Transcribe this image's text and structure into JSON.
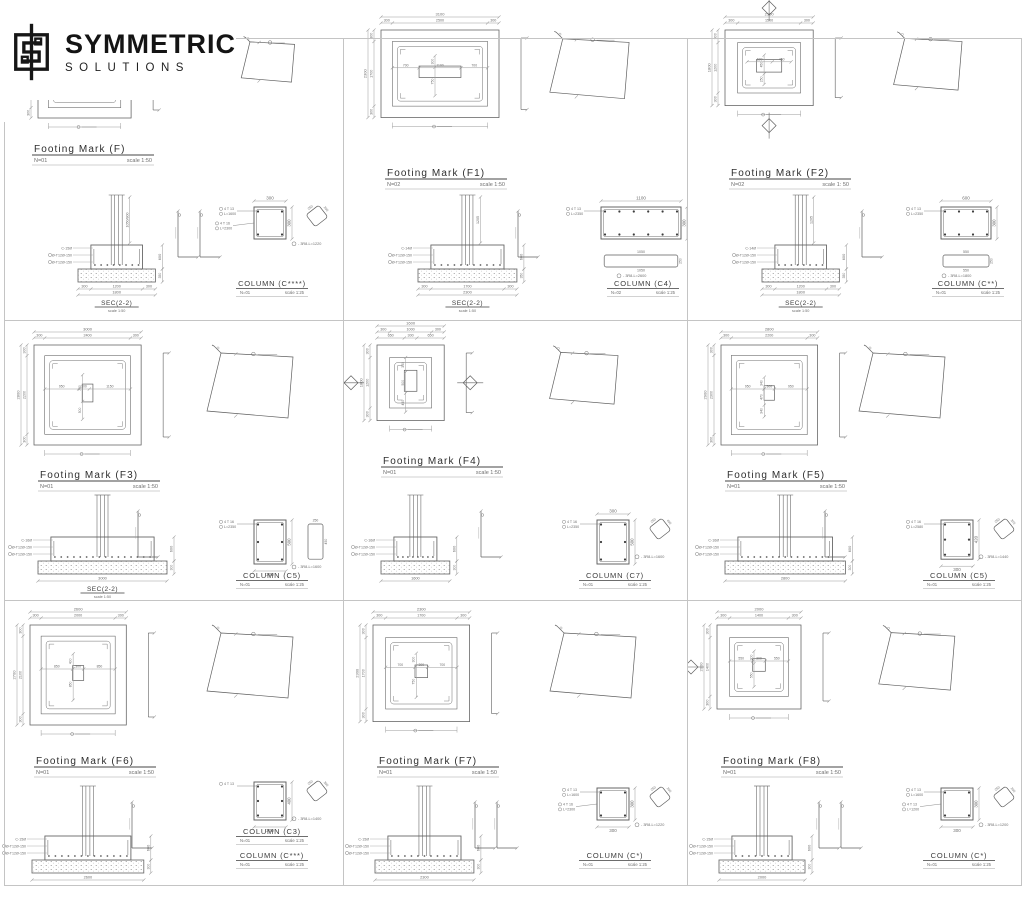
{
  "brand": {
    "name": "SYMMETRIC",
    "sub": "SOLUTIONS"
  },
  "colors": {
    "line": "#5f5f5f",
    "dim": "#9b9b9b",
    "text": "#6e6e6e",
    "title": "#3c3c3c"
  },
  "panels": [
    {
      "footing": {
        "title": "Footing Mark (F)",
        "count": "N=01",
        "scale": "scale 1:50"
      },
      "plan": {
        "partial": true,
        "w_total": "",
        "w_segs": [],
        "h_total": "",
        "h_segs": [
          "",
          "",
          "300"
        ],
        "inner_h": [],
        "inner_v": [],
        "markers": []
      },
      "sec": {
        "title": "SEC(2-2)",
        "scale": "scale 1:50",
        "total": "1800",
        "segs": [
          "300",
          "1200",
          "300"
        ],
        "depth": "600",
        "base": "350",
        "stem": "1050/800",
        "callouts": [
          "C-15Ø",
          "Ø-T12Ø-150",
          "Ø-T12Ø-150"
        ],
        "l_bars": 2
      },
      "column": {
        "w": "300",
        "h": "300",
        "w_pos": "top",
        "h_pos": "right",
        "bars": [
          "4 T 13",
          "L=1600"
        ],
        "bars2": [
          "4 T 16",
          "L=2300"
        ],
        "tie": "3R8-L=1220",
        "stirrup": {
          "orient": "tilt",
          "dims": [
            "250",
            "250"
          ]
        },
        "titles": [
          {
            "title": "COLUMN (C****)",
            "count": "N=01",
            "scale": "scale 1:25"
          }
        ]
      }
    },
    {
      "footing": {
        "title": "Footing Mark (F1)",
        "count": "N=02",
        "scale": "scale 1:50"
      },
      "plan": {
        "w_total": "3100",
        "w_segs": [
          "300",
          "2500",
          "300"
        ],
        "h_total": "2300",
        "h_segs": [
          "300",
          "1700",
          "300"
        ],
        "inner_h": [
          "700",
          "1100",
          "700"
        ],
        "inner_v": [
          "300",
          "750"
        ],
        "markers": []
      },
      "sec": {
        "title": "SEC(2-2)",
        "scale": "scale 1:50",
        "total": "2300",
        "segs": [
          "300",
          "1700",
          "300"
        ],
        "depth": "600",
        "base": "350",
        "stem": "1205",
        "callouts": [
          "C-14Ø",
          "Ø-T12Ø-150",
          "Ø-T12Ø-150"
        ],
        "l_bars": 1
      },
      "column": {
        "w": "1100",
        "h": "300",
        "w_pos": "top",
        "h_pos": "right",
        "bars": [
          "4 T 13",
          "L=2350"
        ],
        "tie": "3R8-L=2600",
        "stirrup": {
          "orient": "h",
          "dims": [
            "1050",
            "250",
            "1050"
          ]
        },
        "titles": [
          {
            "title": "COLUMN (C4)",
            "count": "N=02",
            "scale": "scale 1:25"
          }
        ]
      }
    },
    {
      "footing": {
        "title": "Footing Mark (F2)",
        "count": "N=02",
        "scale": "scale 1: 50"
      },
      "plan": {
        "w_total": "2100",
        "w_segs": [
          "300",
          "1500",
          "300"
        ],
        "h_total": "1800",
        "h_segs": [
          "300",
          "1200",
          "300"
        ],
        "inner_h": [
          "600",
          "450"
        ],
        "inner_v": [
          "450",
          "250"
        ],
        "markers": [
          "top",
          "bottom"
        ]
      },
      "sec": {
        "title": "SEC(2-2)",
        "scale": "scale 1:50",
        "total": "1800",
        "segs": [
          "300",
          "1200",
          "300"
        ],
        "depth": "600",
        "base": "350",
        "stem": "1205",
        "callouts": [
          "C-14Ø",
          "Ø-T12Ø-150",
          "Ø-T12Ø-150"
        ],
        "l_bars": 1
      },
      "column": {
        "w": "600",
        "h": "300",
        "w_pos": "top",
        "h_pos": "right",
        "bars": [
          "4 T 13",
          "L=2350"
        ],
        "tie": "3R8-L=1800",
        "stirrup": {
          "orient": "h",
          "dims": [
            "550",
            "250",
            "550"
          ]
        },
        "titles": [
          {
            "title": "COLUMN (C**)",
            "count": "N=01",
            "scale": "scale 1:25"
          }
        ]
      }
    },
    {
      "footing": {
        "title": "Footing Mark (F3)",
        "count": "N=01",
        "scale": "scale 1:50"
      },
      "plan": {
        "w_total": "3000",
        "w_segs": [
          "300",
          "2400",
          "300"
        ],
        "h_total": "2800",
        "h_segs": [
          "300",
          "2200",
          "300"
        ],
        "inner_h": [
          "950",
          "300",
          "1150"
        ],
        "inner_v": [
          "750",
          "500"
        ],
        "markers": []
      },
      "sec": {
        "title": "SEC(2-2)",
        "scale": "scale 1:50",
        "total": "3000",
        "segs": [],
        "depth": "600",
        "base": "300",
        "stem": "",
        "callouts": [
          "C-16Ø",
          "Ø-T12Ø-150",
          "Ø-T12Ø-150"
        ],
        "l_bars": 1
      },
      "column": {
        "w": "300",
        "h": "500",
        "w_pos": "bottom",
        "h_pos": "right",
        "bars": [
          "4 T 16",
          "L=2350"
        ],
        "tie": "3R8-L=1600",
        "stirrup": {
          "orient": "v",
          "dims": [
            "250",
            "450"
          ]
        },
        "titles": [
          {
            "title": "COLUMN (C5)",
            "count": "N=01",
            "scale": "scale 1:25"
          }
        ]
      }
    },
    {
      "footing": {
        "title": "Footing Mark (F4)",
        "count": "N=01",
        "scale": "scale 1:50"
      },
      "plan": {
        "w_total": "1600",
        "w_segs": [
          "300",
          "1000",
          "300"
        ],
        "w_segs2": [
          "650",
          "300",
          "650"
        ],
        "h_total": "1800",
        "h_segs": [
          "300",
          "1200",
          "300"
        ],
        "inner_h": [],
        "inner_v": [
          "350",
          "500",
          "450"
        ],
        "markers": [
          "left",
          "right"
        ]
      },
      "sec": {
        "title": "",
        "scale": "",
        "total": "1600",
        "segs": [],
        "depth": "600",
        "base": "300",
        "stem": "",
        "callouts": [
          "C-16Ø",
          "Ø-T12Ø-150",
          "Ø-T12Ø-150"
        ],
        "l_bars": 1
      },
      "column": {
        "w": "300",
        "h": "500",
        "w_pos": "top",
        "h_pos": "right",
        "bars": [
          "4 T 16",
          "L=2350"
        ],
        "tie": "3R8-L=1600",
        "stirrup": {
          "orient": "tilt",
          "dims": [
            "250",
            "450"
          ]
        },
        "titles": [
          {
            "title": "COLUMN (C7)",
            "count": "N=01",
            "scale": "scale 1:25"
          }
        ]
      }
    },
    {
      "footing": {
        "title": "Footing Mark (F5)",
        "count": "N=01",
        "scale": "scale 1:50"
      },
      "plan": {
        "w_total": "2800",
        "w_segs": [
          "300",
          "2200",
          "300"
        ],
        "h_total": "2900",
        "h_segs": [
          "300",
          "2300",
          "300"
        ],
        "inner_h": [
          "950",
          "300",
          "950"
        ],
        "inner_v": [
          "340",
          "470",
          "340"
        ],
        "markers": []
      },
      "sec": {
        "title": "",
        "scale": "",
        "total": "2800",
        "segs": [],
        "depth": "600",
        "base": "300",
        "stem": "",
        "callouts": [
          "C-16Ø",
          "Ø-T12Ø-150",
          "Ø-T12Ø-150"
        ],
        "l_bars": 1
      },
      "column": {
        "w": "300",
        "h": "420",
        "w_pos": "bottom",
        "h_pos": "right",
        "bars": [
          "4 T 16",
          "L=2580"
        ],
        "tie": "3R8-L=1440",
        "stirrup": {
          "orient": "tilt",
          "dims": [
            "250",
            "370"
          ]
        },
        "titles": [
          {
            "title": "COLUMN (C5)",
            "count": "N=01",
            "scale": "scale 1:25"
          }
        ]
      }
    },
    {
      "footing": {
        "title": "Footing Mark (F6)",
        "count": "N=01",
        "scale": "scale 1:50"
      },
      "plan": {
        "w_total": "2600",
        "w_segs": [
          "300",
          "2000",
          "300"
        ],
        "h_total": "2700",
        "h_segs": [
          "300",
          "2100",
          "300"
        ],
        "inner_h": [
          "850",
          "300",
          "850"
        ],
        "inner_v": [
          "400",
          "850"
        ],
        "markers": []
      },
      "sec": {
        "title": "",
        "scale": "",
        "total": "2600",
        "segs": [],
        "depth": "600",
        "base": "300",
        "stem": "",
        "callouts": [
          "C-15Ø",
          "Ø-T12Ø-150",
          "Ø-T12Ø-150"
        ],
        "l_bars": 1
      },
      "column": {
        "w": "300",
        "h": "400",
        "w_pos": "bottom",
        "h_pos": "right",
        "bars": [
          "4 T 13"
        ],
        "tie": "3R8-L=1400",
        "stirrup": {
          "orient": "tilt",
          "dims": [
            "250",
            "350"
          ]
        },
        "titles": [
          {
            "title": "COLUMN (C3)",
            "count": "N=01",
            "scale": "scale 1:25"
          },
          {
            "title": "COLUMN (C***)",
            "count": "N=01",
            "scale": "scale 1:25"
          }
        ]
      }
    },
    {
      "footing": {
        "title": "Footing Mark (F7)",
        "count": "N=01",
        "scale": "scale 1:50"
      },
      "plan": {
        "w_total": "2300",
        "w_segs": [
          "300",
          "1700",
          "300"
        ],
        "h_total": "2300",
        "h_segs": [
          "300",
          "1700",
          "300"
        ],
        "inner_h": [
          "700",
          "300",
          "700"
        ],
        "inner_v": [
          "300",
          "750"
        ],
        "markers": []
      },
      "sec": {
        "title": "",
        "scale": "",
        "total": "2300",
        "segs": [],
        "depth": "600",
        "base": "300",
        "stem": "",
        "callouts": [
          "C-15Ø",
          "Ø-T12Ø-150",
          "Ø-T12Ø-150"
        ],
        "l_bars": 2
      },
      "column": {
        "w": "300",
        "h": "300",
        "w_pos": "bottom",
        "h_pos": "right",
        "bars": [
          "4 T 13",
          "L=1600"
        ],
        "bars2": [
          "4 T 16",
          "L=2300"
        ],
        "tie": "3R8-L=1220",
        "stirrup": {
          "orient": "tilt",
          "dims": [
            "250",
            "250"
          ]
        },
        "titles": [
          {
            "title": "COLUMN (C*)",
            "count": "N=01",
            "scale": "scale 1:25"
          }
        ]
      }
    },
    {
      "footing": {
        "title": "Footing Mark (F8)",
        "count": "N=01",
        "scale": "scale 1:50"
      },
      "plan": {
        "w_total": "2000",
        "w_segs": [
          "300",
          "1400",
          "300"
        ],
        "h_total": "2000",
        "h_segs": [
          "300",
          "1400",
          "300"
        ],
        "inner_h": [
          "550",
          "300",
          "550"
        ],
        "inner_v": [
          "300",
          "550"
        ],
        "markers": [
          "left"
        ]
      },
      "sec": {
        "title": "",
        "scale": "",
        "total": "2000",
        "segs": [],
        "depth": "600",
        "base": "300",
        "stem": "",
        "callouts": [
          "C-15Ø",
          "Ø-T12Ø-150",
          "Ø-T12Ø-150"
        ],
        "l_bars": 2
      },
      "column": {
        "w": "300",
        "h": "300",
        "w_pos": "bottom",
        "h_pos": "right",
        "bars": [
          "4 T 13",
          "L=1600"
        ],
        "bars2": [
          "4 T 13",
          "L=1200"
        ],
        "tie": "3R8-L=1200",
        "stirrup": {
          "orient": "tilt",
          "dims": [
            "250",
            "250"
          ]
        },
        "titles": [
          {
            "title": "COLUMN (C*)",
            "count": "N=01",
            "scale": "scale 1:25"
          }
        ]
      }
    }
  ]
}
